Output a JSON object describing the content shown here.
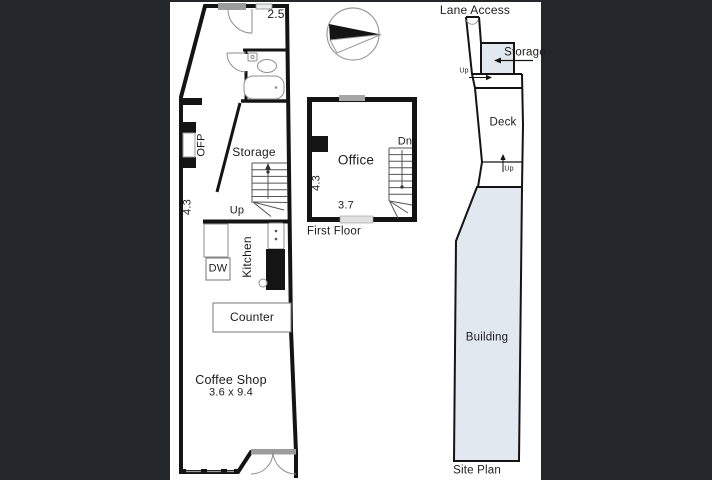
{
  "canvas": {
    "background": "#23272c",
    "paper": "#ffffff",
    "wall_color": "#141414",
    "site_fill_color": "#e2e8f0",
    "window_fill_color": "#9c9c9c"
  },
  "ground_floor": {
    "dim_width_top": "2.5",
    "dim_depth_left": "4.3",
    "ofp_label": "OFP",
    "storage_label": "Storage",
    "up_label": "Up",
    "kitchen_label": "Kitchen",
    "dw_label": "DW",
    "counter_label": "Counter",
    "room_label": "Coffee Shop",
    "room_dims": "3.6 x 9.4"
  },
  "first_floor": {
    "room_label": "Office",
    "dn_label": "Dn",
    "dim_depth_left": "4.3",
    "dim_width_bottom": "3.7",
    "caption": "First Floor"
  },
  "site_plan": {
    "lane_label": "Lane Access",
    "storage_label": "Storage",
    "up_label_top": "Up",
    "deck_label": "Deck",
    "up_label_mid": "Up",
    "building_label": "Building",
    "caption": "Site Plan"
  }
}
